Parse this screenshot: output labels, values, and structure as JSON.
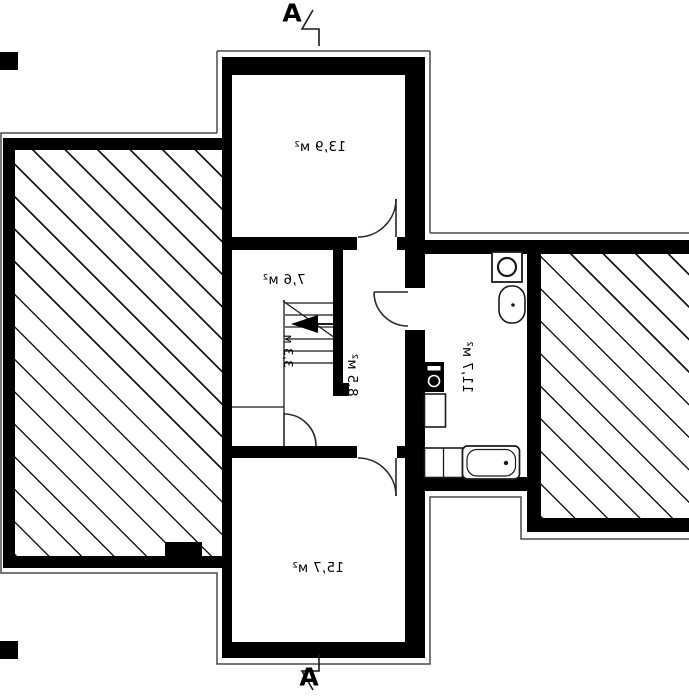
{
  "section_markers": {
    "top": "A",
    "bottom": "A"
  },
  "rooms": {
    "room_13_9": "13,9 м²",
    "room_7_6": "7,6 м²",
    "hall_8_5": "8,5 м²",
    "bath_11_7": "11,7 м²",
    "room_15_7": "15,7 м²"
  },
  "stairs": {
    "length": "3,3 м"
  },
  "fixtures": [
    "washing-machine",
    "washbasin",
    "boiler",
    "cabinet",
    "bathtub"
  ],
  "colors": {
    "wall": "#000000",
    "thin_line": "#4a4a4a",
    "hatch_line": "#1a1a1a",
    "background": "#ffffff"
  }
}
